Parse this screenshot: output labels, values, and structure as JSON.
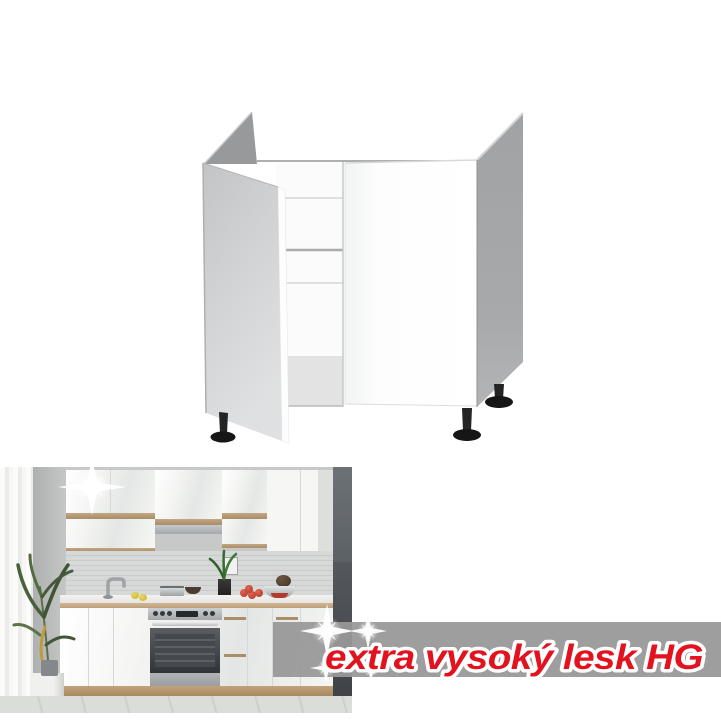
{
  "page": {
    "background_color": "#ffffff",
    "content": "product listing image: white kitchen sink base cabinet render above a gloss-white kitchen photo"
  },
  "promo": {
    "text": "extra vysoký lesk HG",
    "text_color": "#e2121f",
    "outline_color": "#ffffff",
    "band_color": "#989898"
  },
  "decorations": {
    "sparkle_icon": "four-point-star",
    "sparkle_color": "#ffffff",
    "sparkle_count": 5
  },
  "colors": {
    "cabinet_side_panel_gray": "#a3a5a7",
    "cabinet_open_door_gray": "#ced0d2",
    "cabinet_front_white": "#fdfdfd",
    "cabinet_leg_black": "#1e1e1e",
    "kitchen_wood_accent": "#b3956f",
    "kitchen_dark_wall": "#5c6165",
    "kitchen_tile_gray": "#d0d3d1",
    "kitchen_floor_gray": "#d8dad6"
  }
}
